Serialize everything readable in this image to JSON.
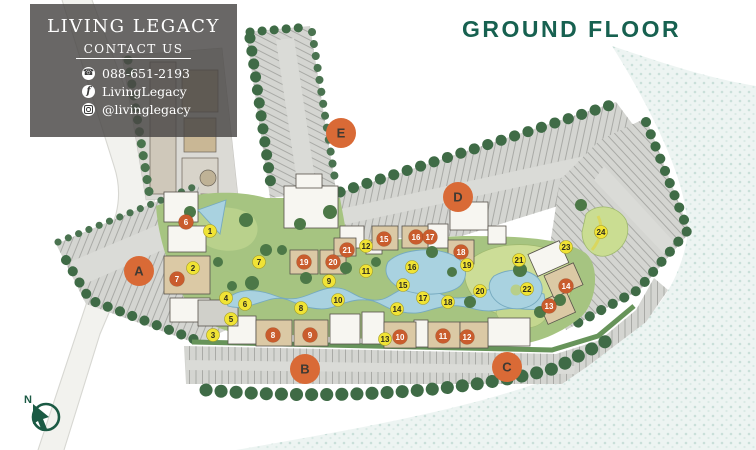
{
  "title": "GROUND FLOOR",
  "contact_panel": {
    "brand": "LIVING LEGACY",
    "heading": "CONTACT US",
    "items": [
      {
        "icon": "phone-icon",
        "text": "088-651-2193"
      },
      {
        "icon": "facebook-icon",
        "text": "LivingLegacy"
      },
      {
        "icon": "instagram-icon",
        "text": "@livinglegacy"
      }
    ]
  },
  "road_label": "SUKHUMVIT 77 ROAD",
  "compass": {
    "label": "N"
  },
  "plan": {
    "building_markers": [
      {
        "label": "A",
        "x": 139,
        "y": 271
      },
      {
        "label": "B",
        "x": 305,
        "y": 369
      },
      {
        "label": "C",
        "x": 507,
        "y": 367
      },
      {
        "label": "D",
        "x": 458,
        "y": 197
      },
      {
        "label": "E",
        "x": 341,
        "y": 133
      }
    ],
    "unit_markers": [
      {
        "n": 6,
        "x": 186,
        "y": 222
      },
      {
        "n": 7,
        "x": 177,
        "y": 279
      },
      {
        "n": 8,
        "x": 273,
        "y": 335
      },
      {
        "n": 9,
        "x": 310,
        "y": 335
      },
      {
        "n": 10,
        "x": 400,
        "y": 337
      },
      {
        "n": 11,
        "x": 443,
        "y": 336
      },
      {
        "n": 12,
        "x": 467,
        "y": 337
      },
      {
        "n": 13,
        "x": 549,
        "y": 306
      },
      {
        "n": 14,
        "x": 566,
        "y": 286
      },
      {
        "n": 15,
        "x": 384,
        "y": 239
      },
      {
        "n": 16,
        "x": 416,
        "y": 237
      },
      {
        "n": 17,
        "x": 430,
        "y": 237
      },
      {
        "n": 18,
        "x": 461,
        "y": 252
      },
      {
        "n": 19,
        "x": 304,
        "y": 262
      },
      {
        "n": 20,
        "x": 333,
        "y": 262
      },
      {
        "n": 21,
        "x": 347,
        "y": 250
      }
    ],
    "facility_markers": [
      {
        "n": 1,
        "x": 210,
        "y": 231
      },
      {
        "n": 2,
        "x": 193,
        "y": 268
      },
      {
        "n": 3,
        "x": 213,
        "y": 335
      },
      {
        "n": 4,
        "x": 226,
        "y": 298
      },
      {
        "n": 5,
        "x": 231,
        "y": 319
      },
      {
        "n": 6,
        "x": 245,
        "y": 304
      },
      {
        "n": 7,
        "x": 259,
        "y": 262
      },
      {
        "n": 8,
        "x": 301,
        "y": 308
      },
      {
        "n": 9,
        "x": 329,
        "y": 281
      },
      {
        "n": 10,
        "x": 338,
        "y": 300
      },
      {
        "n": 11,
        "x": 366,
        "y": 271
      },
      {
        "n": 12,
        "x": 366,
        "y": 246
      },
      {
        "n": 13,
        "x": 385,
        "y": 339
      },
      {
        "n": 14,
        "x": 397,
        "y": 309
      },
      {
        "n": 15,
        "x": 403,
        "y": 285
      },
      {
        "n": 16,
        "x": 412,
        "y": 267
      },
      {
        "n": 17,
        "x": 423,
        "y": 298
      },
      {
        "n": 18,
        "x": 448,
        "y": 302
      },
      {
        "n": 19,
        "x": 467,
        "y": 265
      },
      {
        "n": 20,
        "x": 480,
        "y": 291
      },
      {
        "n": 21,
        "x": 519,
        "y": 260
      },
      {
        "n": 22,
        "x": 527,
        "y": 289
      },
      {
        "n": 23,
        "x": 566,
        "y": 247
      },
      {
        "n": 24,
        "x": 601,
        "y": 232
      }
    ],
    "colors": {
      "marker_letter_bg": "#d96a36",
      "marker_letter_text": "#3f3a33",
      "marker_unit_bg": "#c95c2d",
      "marker_unit_text": "#ffffff",
      "marker_facility_bg": "#f0e335",
      "marker_facility_text": "#2e2c1e",
      "title_green": "#176150",
      "compass_green": "#1b5a44",
      "pool_blue": "#a9d2e0",
      "water": "#edf4f2",
      "greenery": "#4c7847",
      "parking": "#d4d5d1"
    }
  }
}
